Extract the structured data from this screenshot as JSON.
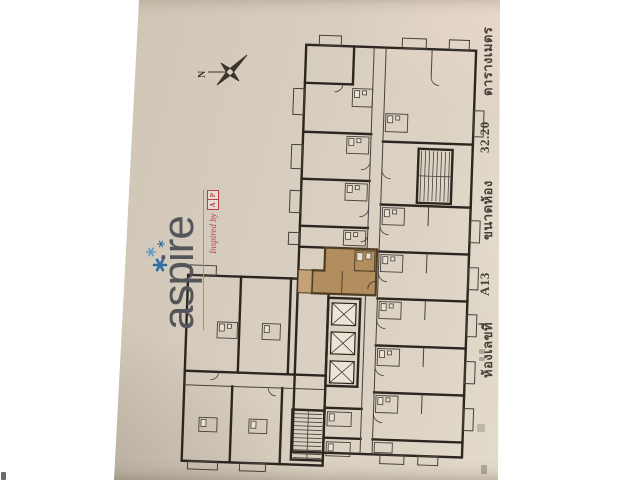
{
  "logo": {
    "brand": "aspire",
    "tagline": "Inspired by",
    "ap_letters": [
      "A",
      "P"
    ],
    "brand_color": "#54555b",
    "star_color": "#2f6fa4",
    "accent_color": "#bb4046"
  },
  "compass": {
    "north_label": "N"
  },
  "unit_info": {
    "items": [
      "ห้องเลขที่",
      "A13",
      "ขนาดห้อง",
      "32.20",
      "ตารางเมตร"
    ]
  },
  "plan": {
    "highlighted_unit": "A13",
    "highlight_color": "#b28e5e",
    "highlight_light": "#c3a277",
    "wall_color": "#2b261f",
    "thin_line_color": "#46403a",
    "paper_color": "#d8cec0",
    "fixture_color": "#e9e1d3",
    "elevator_fill": "#ece4d6"
  }
}
